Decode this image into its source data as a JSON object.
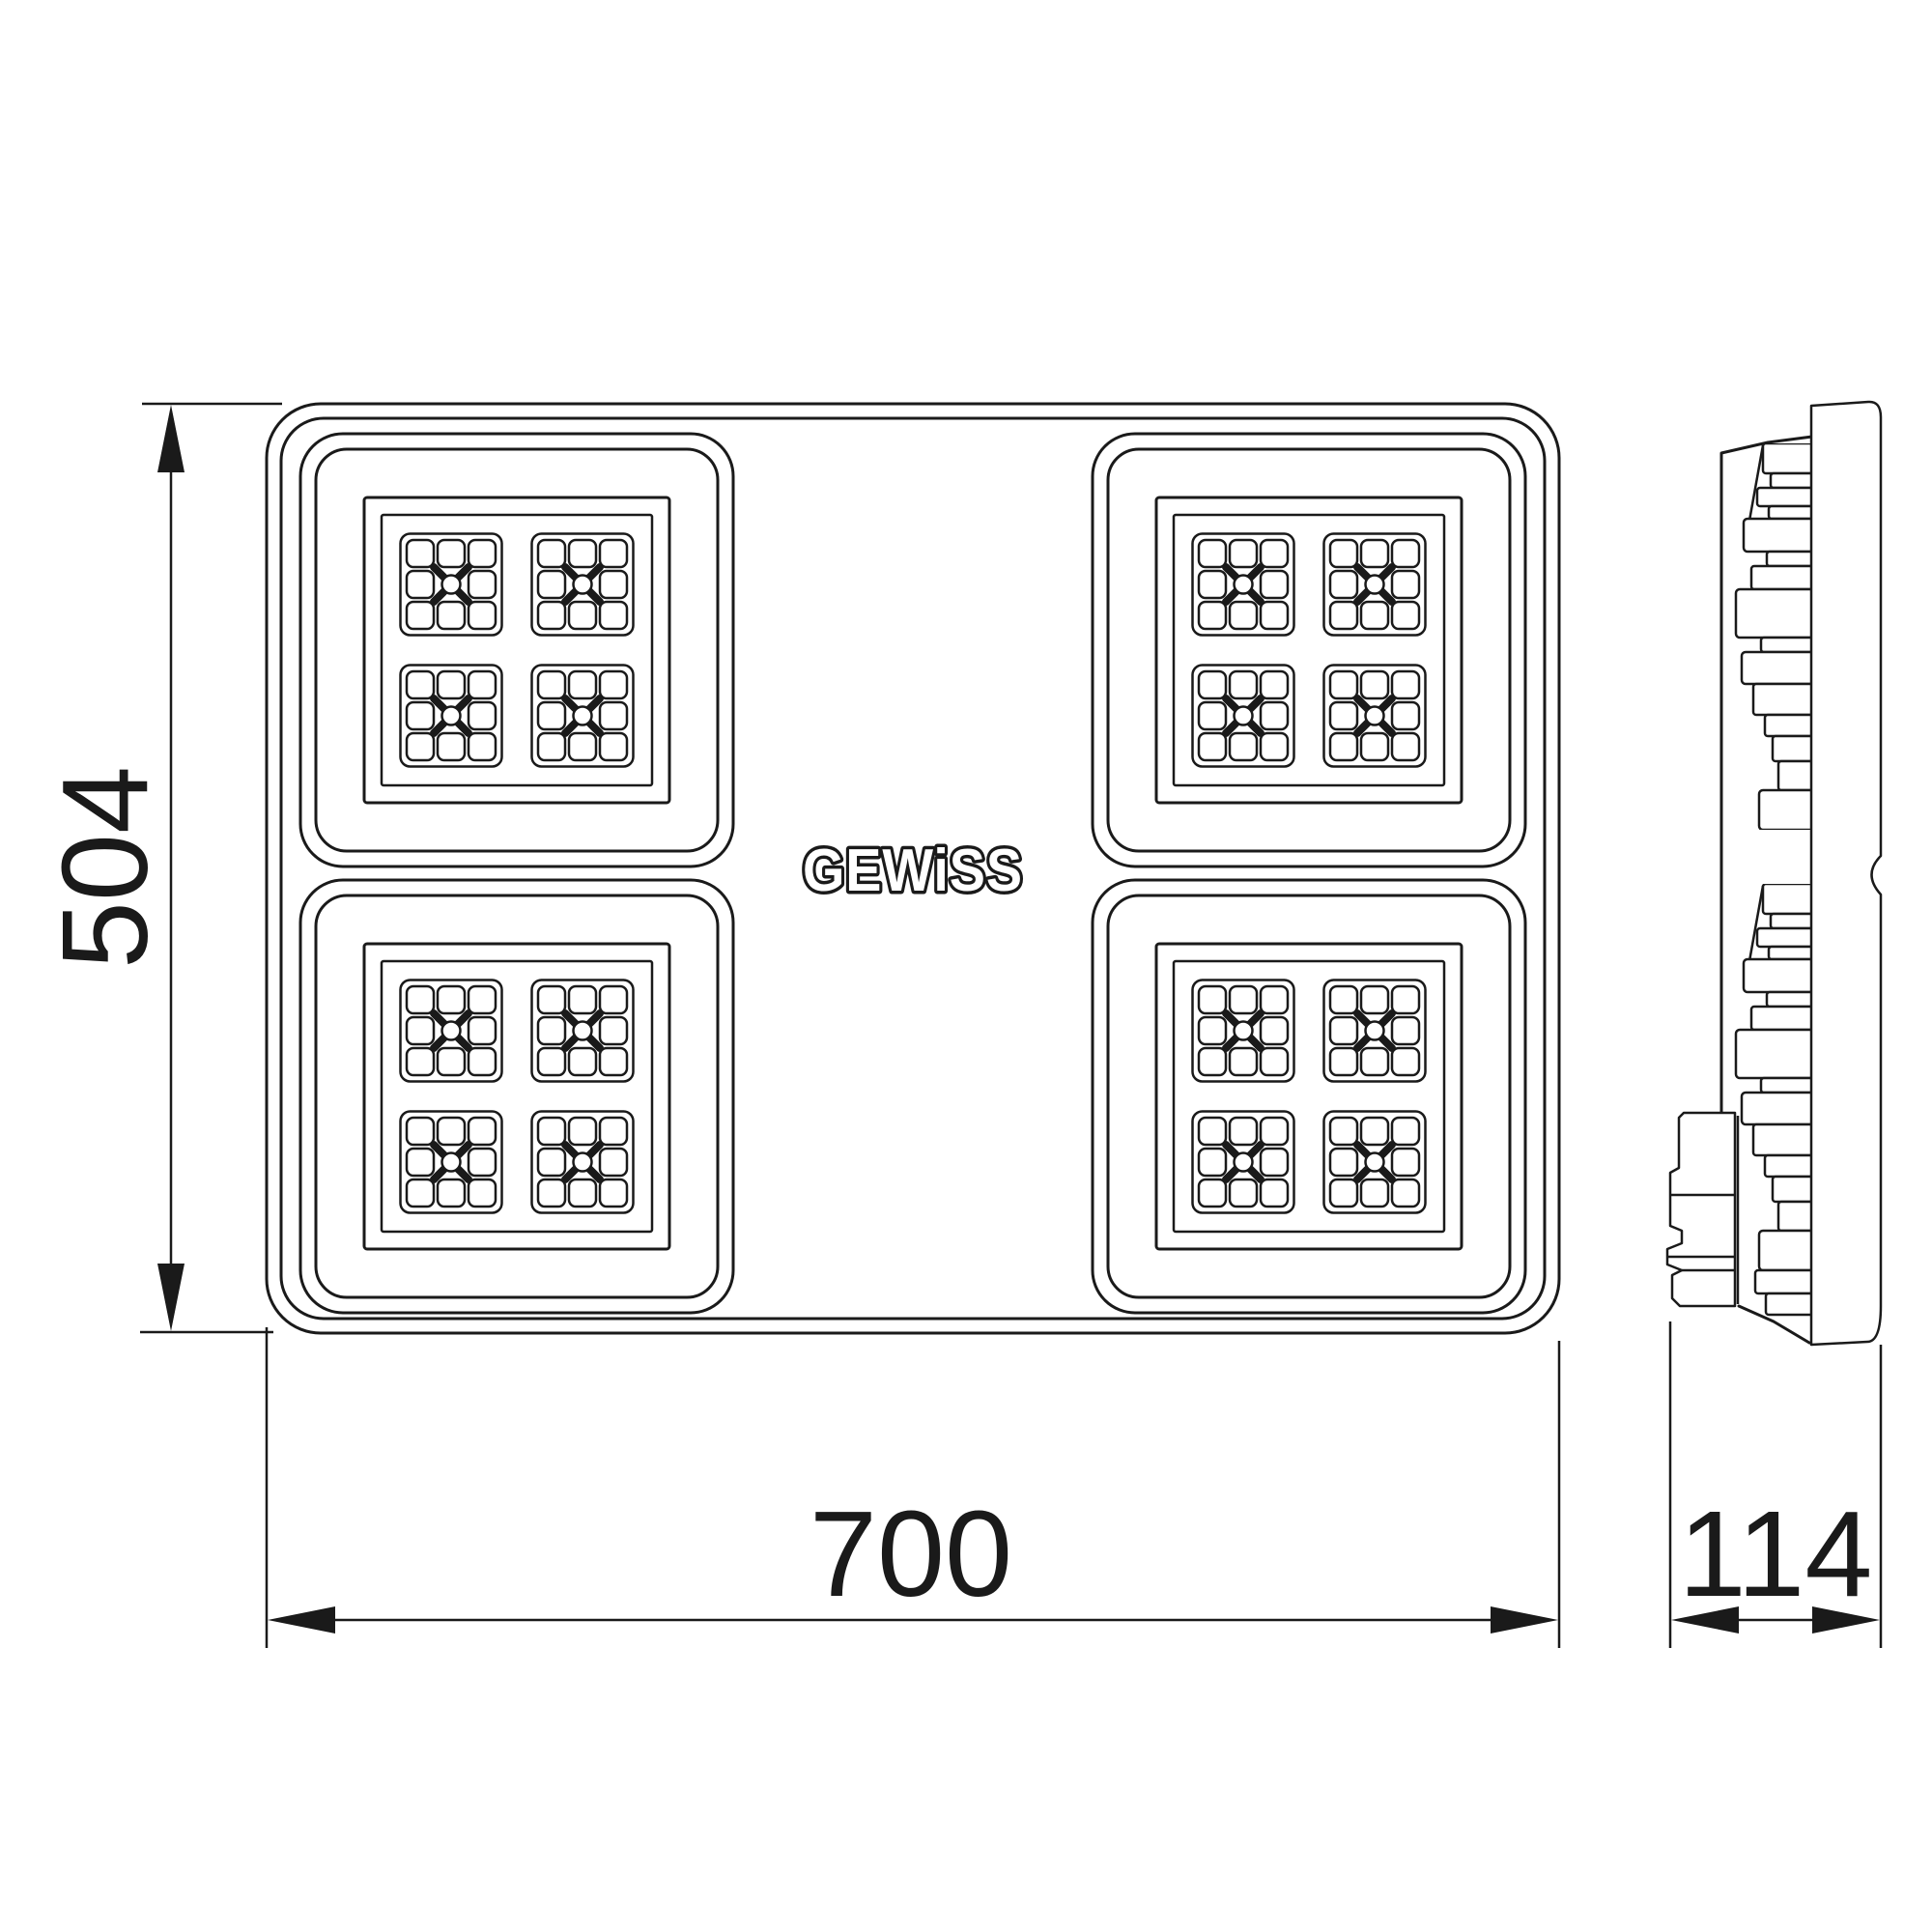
{
  "logo": {
    "text": "GEWiSS"
  },
  "dimensions": {
    "height": {
      "label": "504"
    },
    "width": {
      "label": "700"
    },
    "depth": {
      "label": "114"
    }
  },
  "colors": {
    "line": "#1a1a1a",
    "background": "#ffffff"
  }
}
